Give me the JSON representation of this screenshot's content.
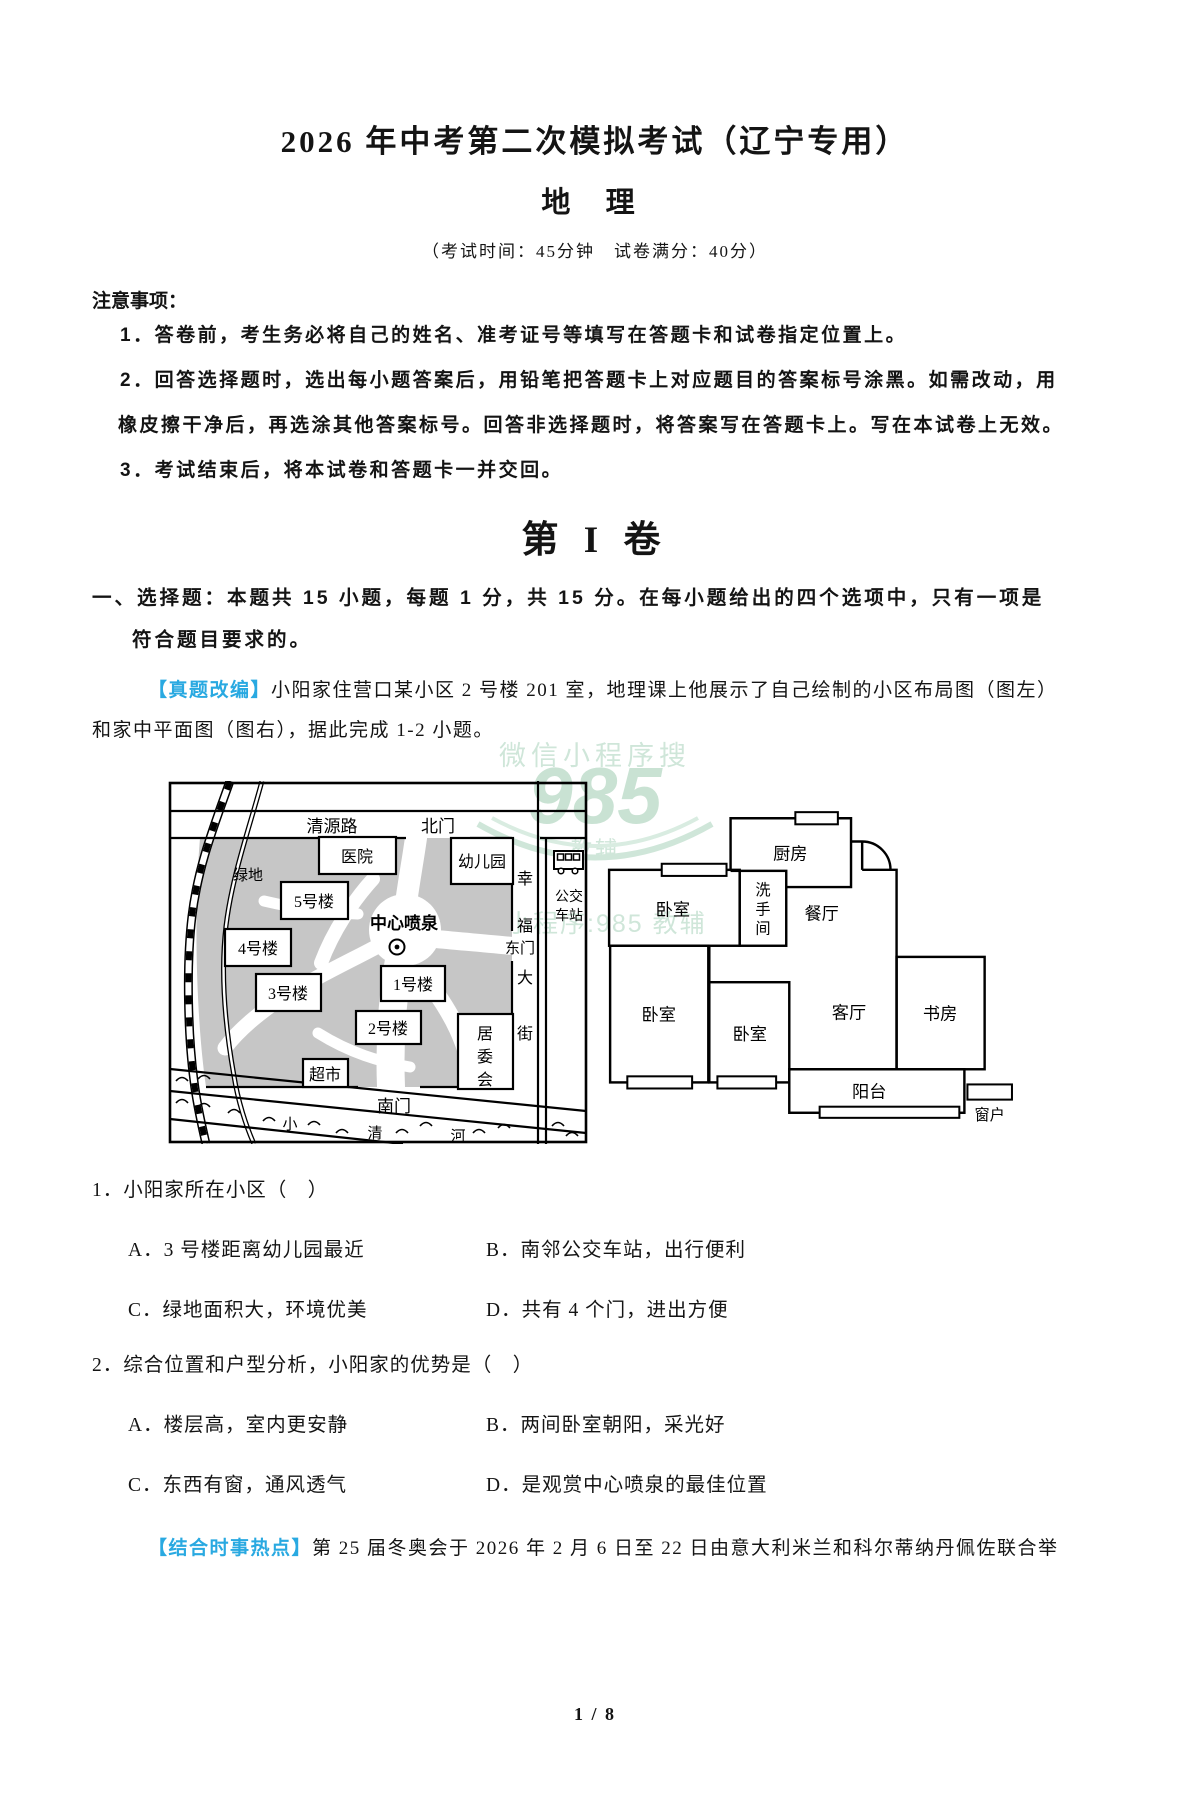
{
  "page": {
    "title": "2026 年中考第二次模拟考试（辽宁专用）",
    "subject": "地 理",
    "exam_info": "（考试时间：45分钟　试卷满分：40分）",
    "footer": "1 / 8"
  },
  "notice": {
    "heading": "注意事项：",
    "line1": "1．答卷前，考生务必将自己的姓名、准考证号等填写在答题卡和试卷指定位置上。",
    "line2a": "2．回答选择题时，选出每小题答案后，用铅笔把答题卡上对应题目的答案标号涂黑。如需改动，用",
    "line2b": "橡皮擦干净后，再选涂其他答案标号。回答非选择题时，将答案写在答题卡上。写在本试卷上无效。",
    "line3": "3．考试结束后，将本试卷和答题卡一并交回。"
  },
  "section": {
    "volume_title": "第 I 卷",
    "instruction_line1": "一、选择题：本题共 15 小题，每题 1 分，共 15 分。在每小题给出的四个选项中，只有一项是",
    "instruction_line2": "符合题目要求的。"
  },
  "passage1": {
    "tag": "【真题改编】",
    "line1": "小阳家住营口某小区 2 号楼 201 室，地理课上他展示了自己绘制的小区布局图（图左）",
    "line2": "和家中平面图（图右），据此完成 1-2 小题。"
  },
  "watermark": {
    "line_top": "微信小程序搜",
    "logo": "985",
    "logo_sub": "教辅",
    "line_bottom": "微信小程序:985 教辅"
  },
  "map": {
    "road_north": "清源路",
    "gate_north": "北门",
    "hospital": "医院",
    "kindergarten": "幼儿园",
    "green_space": "绿地",
    "building5": "5号楼",
    "building4": "4号楼",
    "building3": "3号楼",
    "building1": "1号楼",
    "building2": "2号楼",
    "fountain": "中心喷泉",
    "supermarket": "超市",
    "committee": {
      "c1": "居",
      "c2": "委",
      "c3": "会"
    },
    "street": {
      "c1": "幸",
      "c2": "福",
      "c3": "大",
      "c4": "街"
    },
    "gate_east": "东门",
    "bus_station": {
      "l1": "公交",
      "l2": "车站"
    },
    "gate_south": "南门",
    "river": {
      "c1": "小",
      "c2": "清",
      "c3": "河"
    }
  },
  "floorplan": {
    "kitchen": "厨房",
    "bedroom": "卧室",
    "washroom": {
      "c1": "洗",
      "c2": "手",
      "c3": "间"
    },
    "dining": "餐厅",
    "living": "客厅",
    "study": "书房",
    "balcony": "阳台",
    "window_legend": "窗户"
  },
  "questions": [
    {
      "stem": "1．小阳家所在小区（　）",
      "options": [
        "A．3 号楼距离幼儿园最近",
        "B．南邻公交车站，出行便利",
        "C．绿地面积大，环境优美",
        "D．共有 4 个门，进出方便"
      ]
    },
    {
      "stem": "2．综合位置和户型分析，小阳家的优势是（　）",
      "options": [
        "A．楼层高，室内更安静",
        "B．两间卧室朝阳，采光好",
        "C．东西有窗，通风透气",
        "D．是观赏中心喷泉的最佳位置"
      ]
    }
  ],
  "passage2": {
    "tag": "【结合时事热点】",
    "text": "第 25 届冬奥会于 2026 年 2 月 6 日至 22 日由意大利米兰和科尔蒂纳丹佩佐联合举"
  },
  "colors": {
    "accent_blue": "#29a9e1",
    "watermark_green": "#cfe6d9",
    "map_gray": "#c6c6c6"
  }
}
